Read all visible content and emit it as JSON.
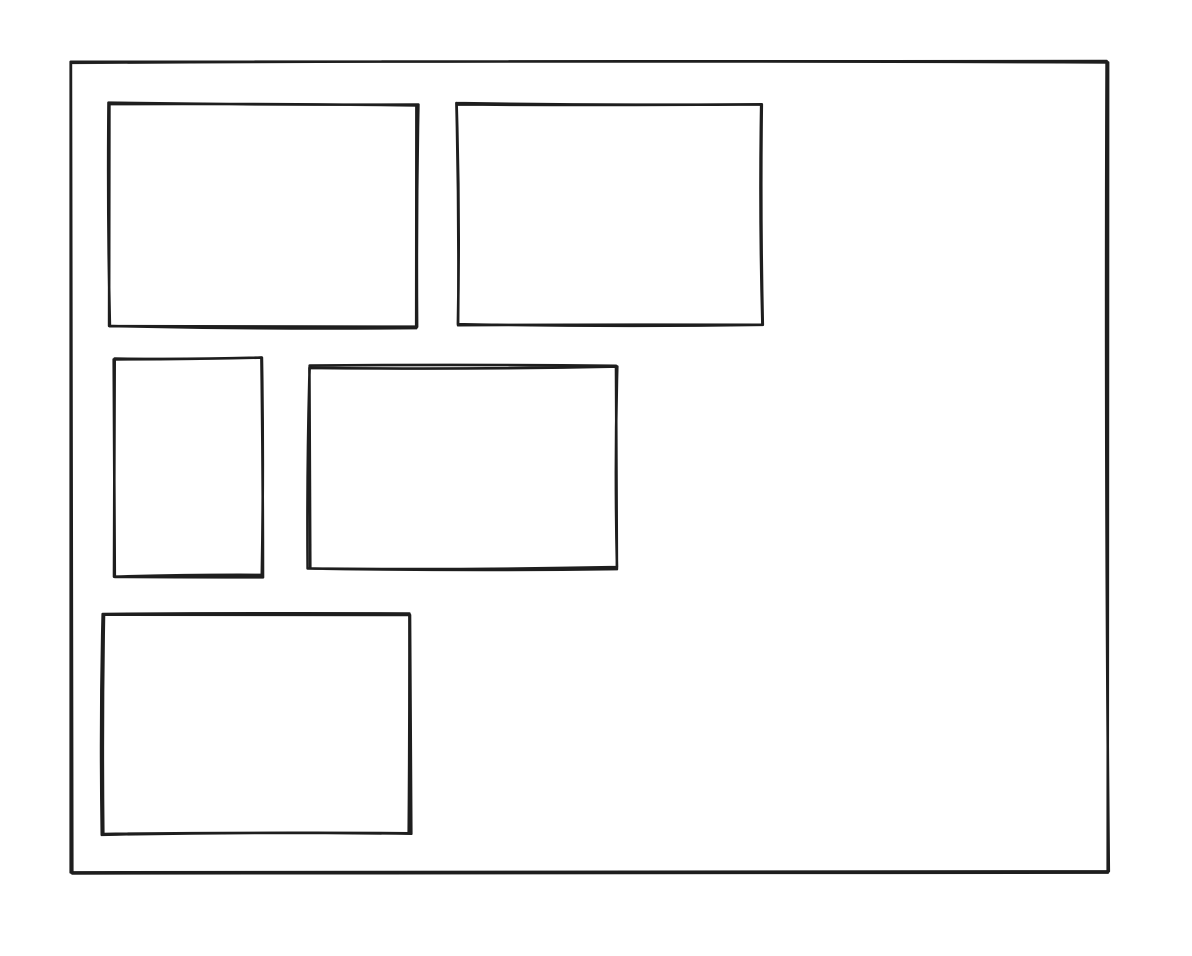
{
  "canvas": {
    "width": 1192,
    "height": 956,
    "background_color": "#ffffff"
  },
  "sketch": {
    "style": "hand-drawn-wireframe",
    "stroke_color": "#1e1e1e",
    "stroke_width": 2.6,
    "fill": "none",
    "frame": {
      "name": "outer-frame",
      "x": 72,
      "y": 62,
      "width": 1036,
      "height": 810
    },
    "boxes": [
      {
        "name": "panel-top-left",
        "x": 110,
        "y": 104,
        "width": 307,
        "height": 223
      },
      {
        "name": "panel-top-right",
        "x": 457,
        "y": 104,
        "width": 305,
        "height": 220
      },
      {
        "name": "panel-middle-left",
        "x": 114,
        "y": 358,
        "width": 148,
        "height": 218
      },
      {
        "name": "panel-middle-right",
        "x": 309,
        "y": 367,
        "width": 307,
        "height": 201
      },
      {
        "name": "panel-bottom-left",
        "x": 103,
        "y": 614,
        "width": 307,
        "height": 220
      }
    ]
  }
}
